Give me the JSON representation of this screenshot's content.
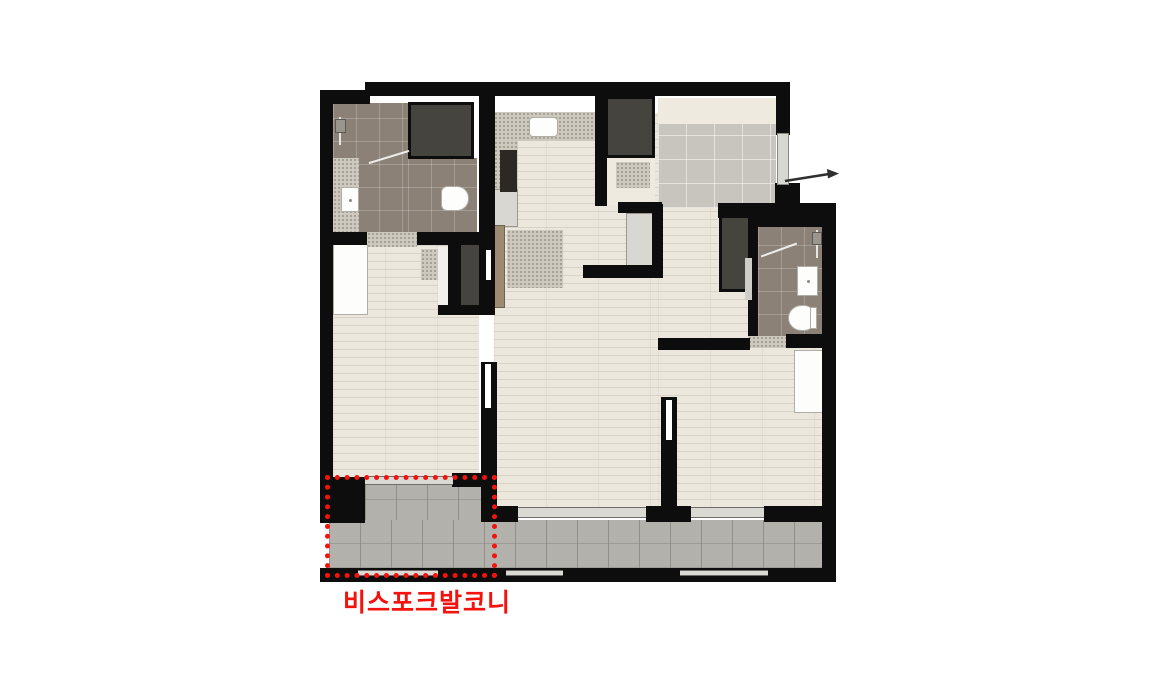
{
  "annotation": {
    "balcony_label": "비스포크발코니",
    "accent_color": "#f3120e"
  },
  "palette": {
    "wall": "#0d0d0d",
    "wood_floor": "#ece7dd",
    "balcony_floor": "#b2b1ac",
    "bathroom_tile": "#8b8177",
    "entry_tile": "#c8c5be",
    "closet_dark": "#46443f",
    "counter_speckle": "#cec9be",
    "fixture_white": "#fdfdfc"
  },
  "icons": {
    "entrance_arrow": "→",
    "shower": "▯"
  }
}
